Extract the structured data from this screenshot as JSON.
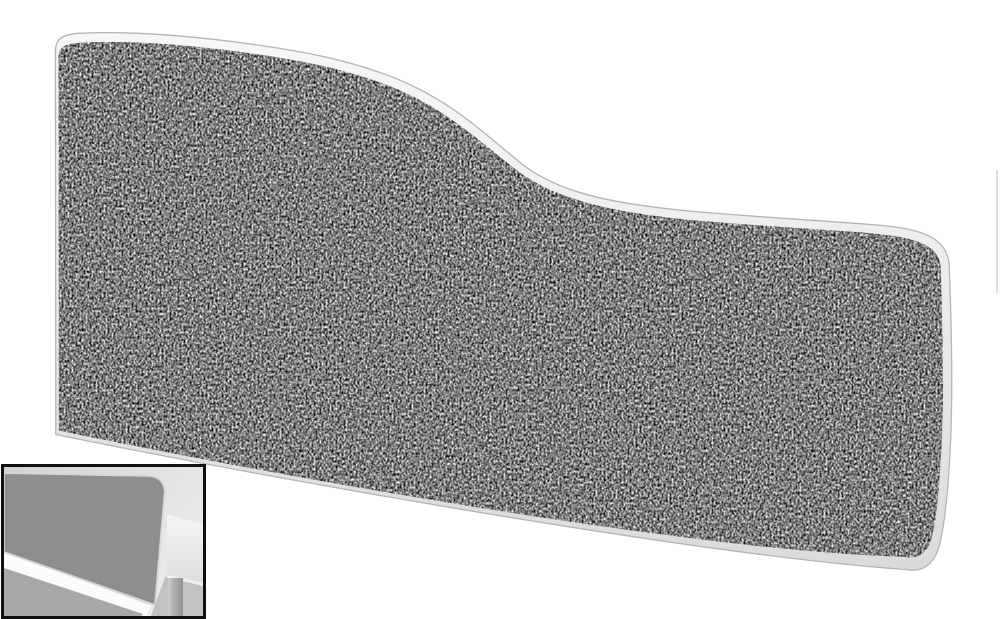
{
  "image_type": "product-photo",
  "scene": {
    "main_product": {
      "label": "Wave top acoustic desk screen, grey speckled tweed fabric with rounded white edge trim, high left side sweeping down to a lower right side",
      "fabric": "grey speckled tweed",
      "trim": "white rounded edge trim"
    },
    "inset": {
      "label": "Thumbnail photo showing the grey screen mounted on the back edge of a white desk against a light wall"
    },
    "artifact": {
      "label": "faint grey line fragment at right image edge"
    }
  },
  "colors": {
    "page-bg": "#ffffff",
    "trim-light": "#f7f7f7",
    "trim-dark": "#dadada",
    "trim-stroke": "#b4b4b4",
    "fabric-mid": "#7d7d7d",
    "edge-artifact": "#d9d9d9",
    "inset-border": "#101010",
    "inset-wall-dark": "#d2d2d2",
    "inset-wall-light": "#f1f1f1",
    "inset-panel": "#8e8e8e",
    "inset-panel-trim": "#d6d6d6",
    "inset-strip-dark": "#9f9f9f",
    "inset-strip-light": "#dadada",
    "inset-desk-light": "#f5f5f5",
    "inset-desk-dark": "#dedede",
    "inset-under-desk": "#c2c2c2",
    "inset-leg-light": "#cfcfcf",
    "inset-leg-dark": "#8f8f8f",
    "inset-floor": "#a8a8a8",
    "inset-band-white": "#fbfbfb"
  }
}
